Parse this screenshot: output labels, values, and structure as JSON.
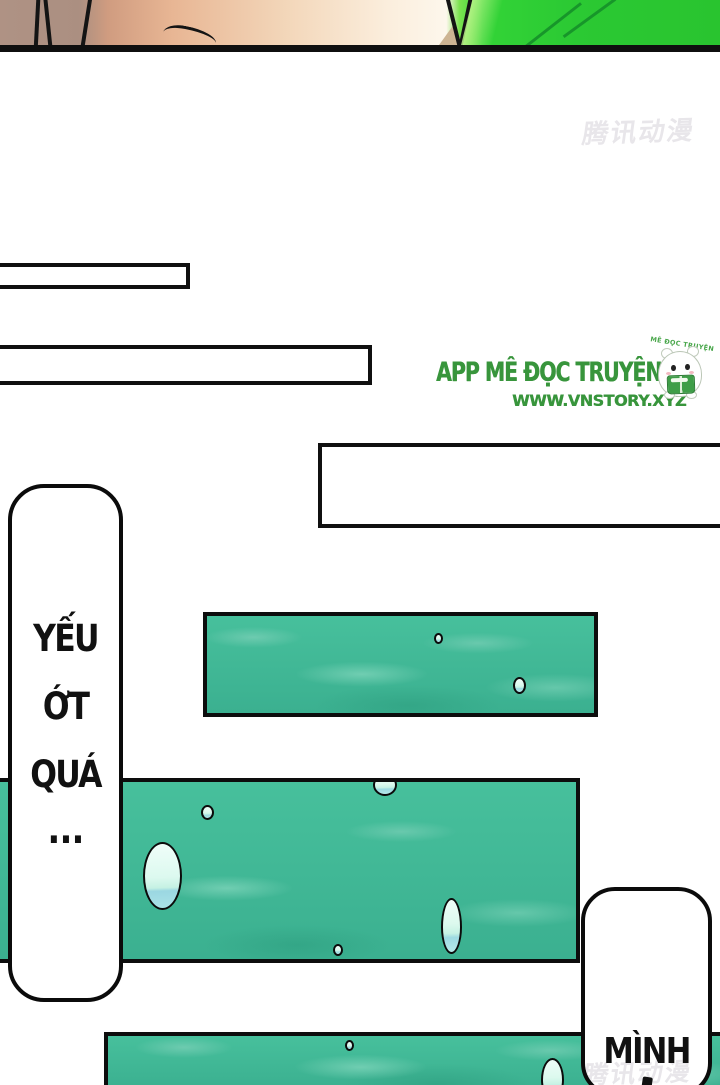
{
  "comic": {
    "top_watermark": "腾讯动漫",
    "bottom_watermark": "腾讯动漫",
    "promo": {
      "app_title": "APP MÊ ĐỌC TRUYỆN",
      "website": "WWW.VNSTORY.XYZ",
      "mascot_arc_text": "MÊ ĐỌC TRUYỆN"
    },
    "speech": {
      "left_bubble_lines": [
        "YẾU",
        "ỚT",
        "QUÁ",
        "..."
      ],
      "right_bubble_line": "MÌNH"
    },
    "colors": {
      "logo_green": "#38953c",
      "water_base": "#41ba97",
      "water_highlight": "#7fd8b6",
      "watermark_gray": "#e8e6ea",
      "ink": "#101010",
      "foliage_green": "#2bc933",
      "skin_peach": "#f3d7ba"
    }
  }
}
